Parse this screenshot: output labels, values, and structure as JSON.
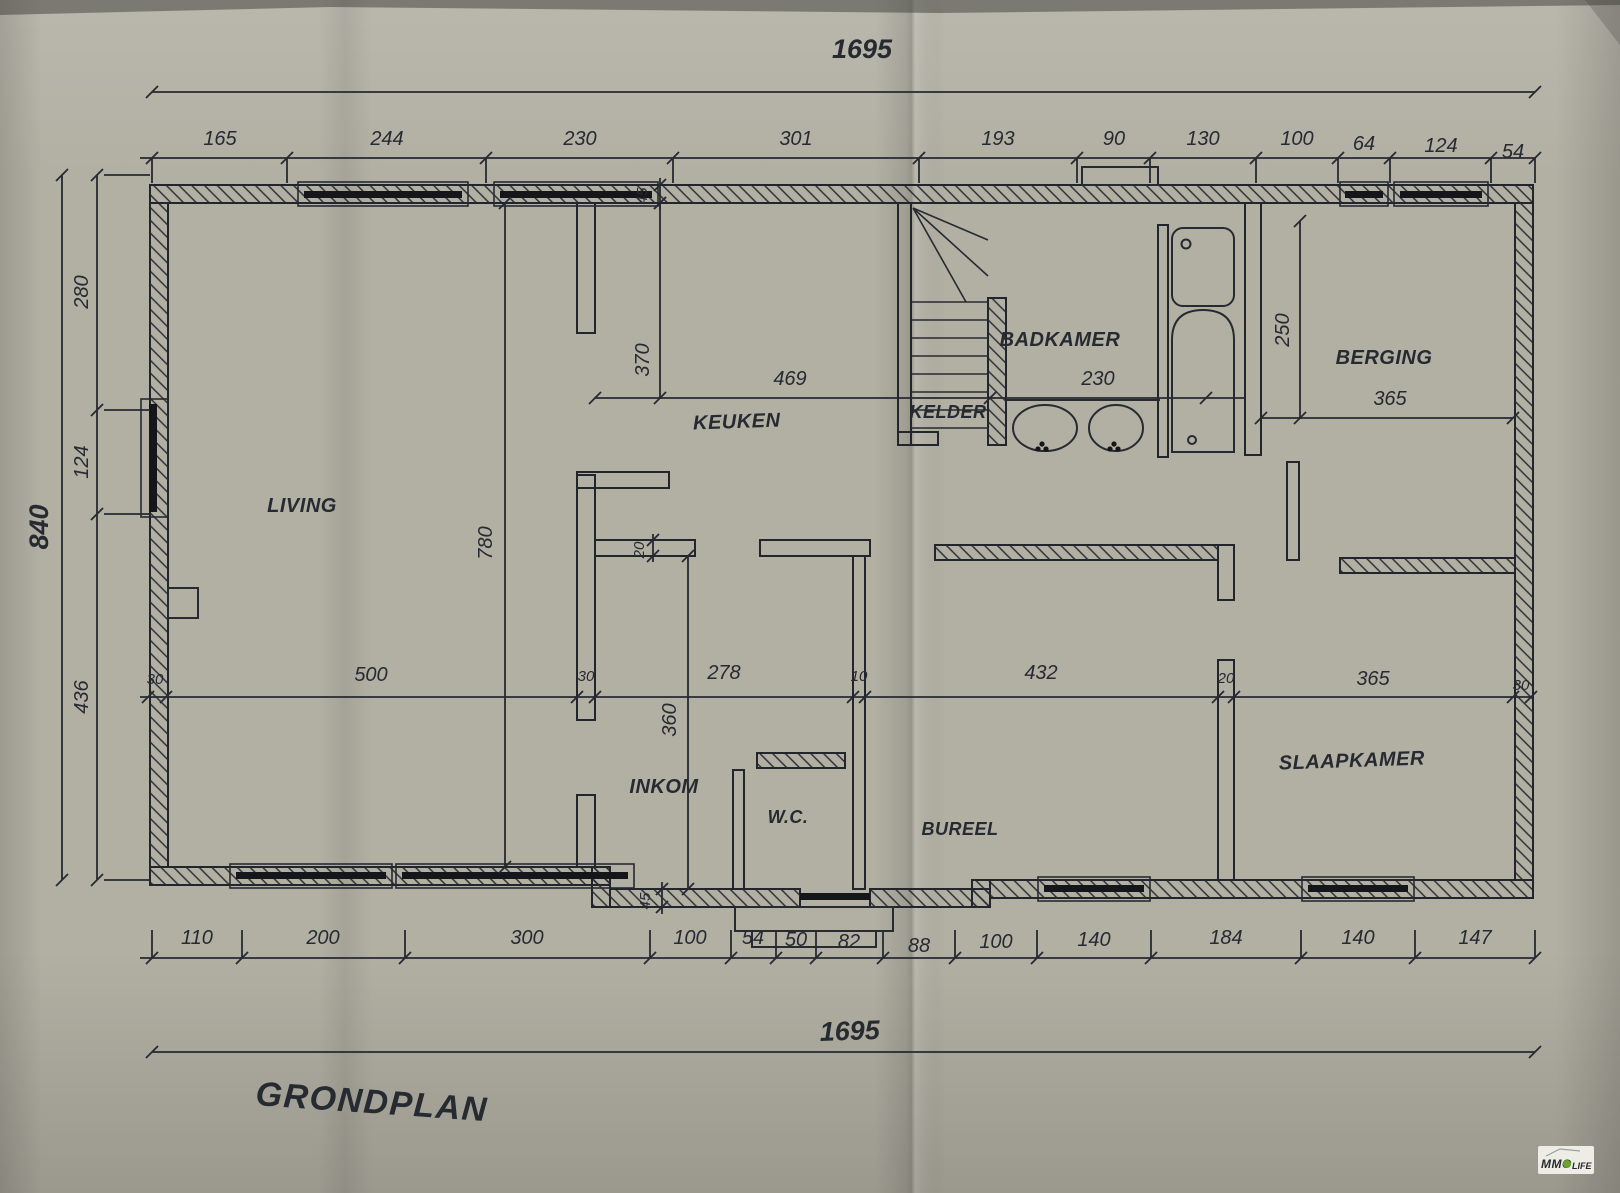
{
  "title": "GRONDPLAN",
  "overall": {
    "top": "1695",
    "bottom": "1695",
    "left": "840"
  },
  "top_chain": [
    "165",
    "244",
    "230",
    "301",
    "193",
    "90",
    "130",
    "100",
    "64",
    "124",
    "54"
  ],
  "left_chain": [
    "280",
    "124",
    "436"
  ],
  "mid_chain": [
    "30",
    "500",
    "30",
    "278",
    "10",
    "432",
    "20",
    "365",
    "30"
  ],
  "bottom_chain": [
    "110",
    "200",
    "300",
    "100",
    "54",
    "50",
    "82",
    "88",
    "100",
    "140",
    "184",
    "140",
    "147"
  ],
  "interior": {
    "keuken_width": "469",
    "keuken_depth": "370",
    "badkamer_width": "230",
    "berging_width": "365",
    "berging_depth": "250",
    "living_depth": "780",
    "inkom_depth": "360",
    "wall_top": "45",
    "wall_bottom": "45",
    "wall_mid": "20"
  },
  "rooms": {
    "living": "LIVING",
    "keuken": "KEUKEN",
    "kelder": "KELDER",
    "badkamer": "BADKAMER",
    "berging": "BERGING",
    "inkom": "INKOM",
    "wc": "W.C.",
    "bureel": "BUREEL",
    "slaapkamer": "SLAAPKAMER"
  },
  "logo": {
    "brand": "MMO",
    "suffix": "LIFE"
  },
  "colors": {
    "ink": "#262a31",
    "paper": "#b2afa3",
    "logo_green": "#69a42c"
  }
}
